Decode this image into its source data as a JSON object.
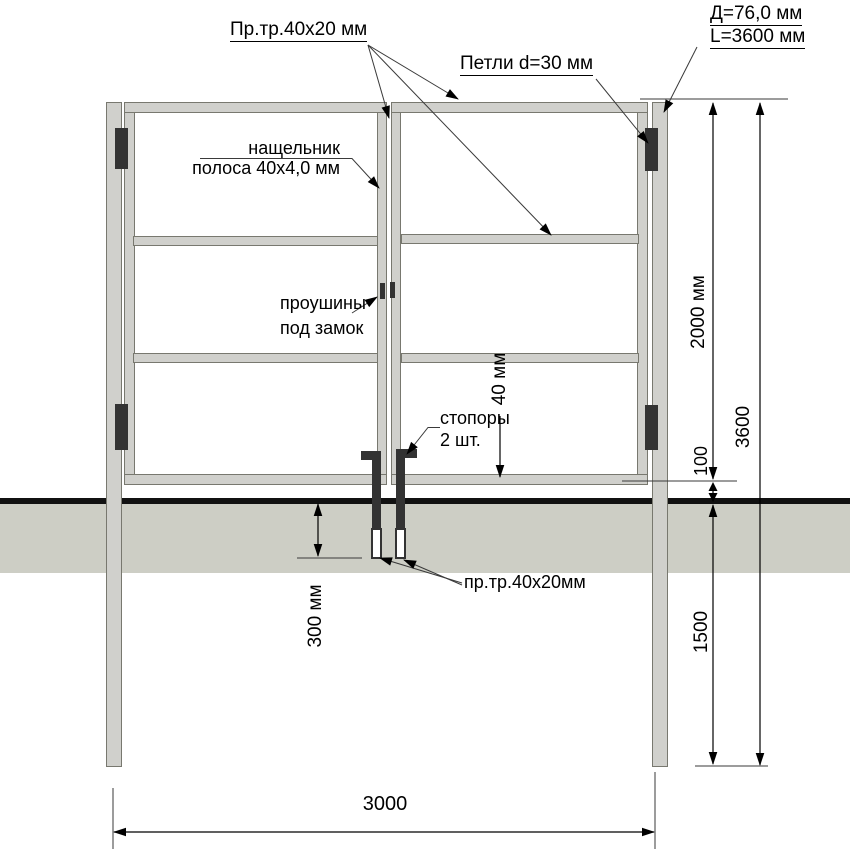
{
  "callouts": {
    "profile_tube": "Пр.тр.40х20 мм",
    "hinges": "Петли d=30 мм",
    "post_diameter": "Д=76,0 мм",
    "post_length": "L=3600 мм",
    "cover_strip_line1": "нащельник",
    "cover_strip_line2": "полоса 40х4,0 мм",
    "lock_lugs_line1": "проушины",
    "lock_lugs_line2": "под замок",
    "stoppers_line1": "стопоры",
    "stoppers_line2": "2 шт.",
    "profile_tube_bottom": "пр.тр.40х20мм"
  },
  "dimensions": {
    "leaf_height": "2000 мм",
    "total_post_length": "3600",
    "ground_gap": "100",
    "buried_depth": "1500",
    "stopper_depth": "300 мм",
    "profile_width": "40 мм",
    "opening_width": "3000"
  },
  "colors": {
    "metal_fill": "#d0d0cc",
    "metal_edge": "#78786f",
    "ground_fill": "#cdcec5",
    "hardware_dark": "#333333",
    "line": "#111111"
  }
}
